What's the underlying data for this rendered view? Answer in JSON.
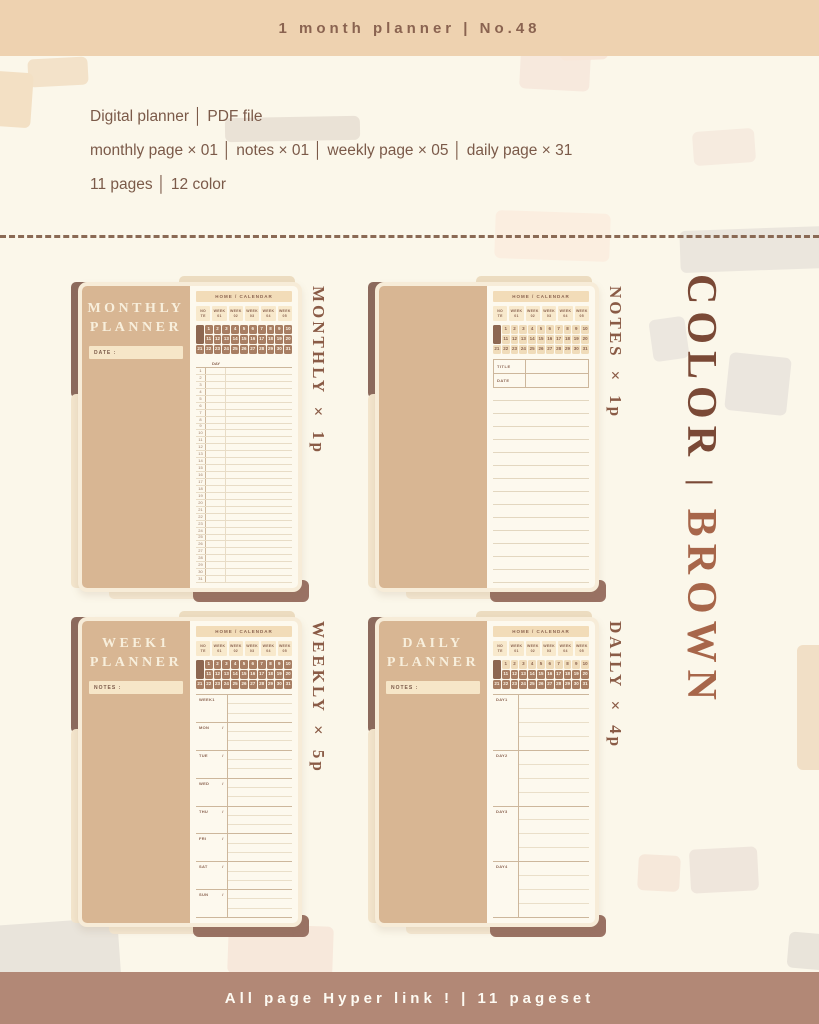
{
  "header": {
    "title": "1 month planner  |  No.48"
  },
  "info": {
    "line1": "Digital planner  │  PDF file",
    "line2": "monthly page × 01  │  notes × 01  │  weekly page × 05  │  daily page × 31",
    "line3": "11 pages  │  12 color"
  },
  "page_template": {
    "header_label": "HOME / CALENDAR",
    "tabs": [
      {
        "l1": "NO",
        "l2": "TE"
      },
      {
        "l1": "WEEK",
        "l2": "01"
      },
      {
        "l1": "WEEK",
        "l2": "02"
      },
      {
        "l1": "WEEK",
        "l2": "03"
      },
      {
        "l1": "WEEK",
        "l2": "04"
      },
      {
        "l1": "WEEK",
        "l2": "05"
      }
    ],
    "days_in_month": 31,
    "monthly": {
      "day_header": "DAY",
      "rows": 31
    },
    "notes": {
      "fields": [
        "TITLE",
        "DATE"
      ],
      "ruled_lines": 15
    },
    "weekly": {
      "rows": [
        "WEEK1",
        "MON",
        "TUE",
        "WED",
        "THU",
        "FRI",
        "SAT",
        "SUN"
      ]
    },
    "daily": {
      "rows": [
        "DAY1",
        "DAY2",
        "DAY3",
        "DAY4"
      ]
    }
  },
  "cards": [
    {
      "id": "monthly",
      "panel_title": [
        "MONTHLY",
        "PLANNER"
      ],
      "panel_field": "DATE :",
      "side_label": "MONTHLY × 1p",
      "body": "monthly",
      "day_style": "dark"
    },
    {
      "id": "notes",
      "panel_title": [],
      "panel_field": "",
      "side_label": "NOTES × 1p",
      "body": "notes",
      "day_style": "light"
    },
    {
      "id": "weekly",
      "panel_title": [
        "WEEK1",
        "PLANNER"
      ],
      "panel_field": "NOTES :",
      "side_label": "WEEKLY × 5p",
      "body": "weekly",
      "day_style": "dark"
    },
    {
      "id": "daily",
      "panel_title": [
        "DAILY",
        "PLANNER"
      ],
      "panel_field": "NOTES :",
      "side_label": "DAILY × 4p",
      "body": "daily",
      "day_style": "first_row_light"
    }
  ],
  "right_banner": {
    "top": "COLOR",
    "divider": "|",
    "bottom": "BROWN"
  },
  "footer": {
    "text": "All page Hyper link !  |  11 pageset"
  },
  "colors": {
    "background": "#fbf7ea",
    "banner_bg": "#eed2b0",
    "banner_text": "#8a6350",
    "info_text": "#7b5a49",
    "panel_tan": "#d8b693",
    "page_cream": "#fdf9ee",
    "day_dark": "#a87e63",
    "day_light": "#f0dcba",
    "spine_dark": "#8c6a5d",
    "color_word": "#7a4936",
    "brown_word": "#a7664a",
    "footer_bg": "#b28876",
    "footer_text": "#fdfaf2"
  }
}
